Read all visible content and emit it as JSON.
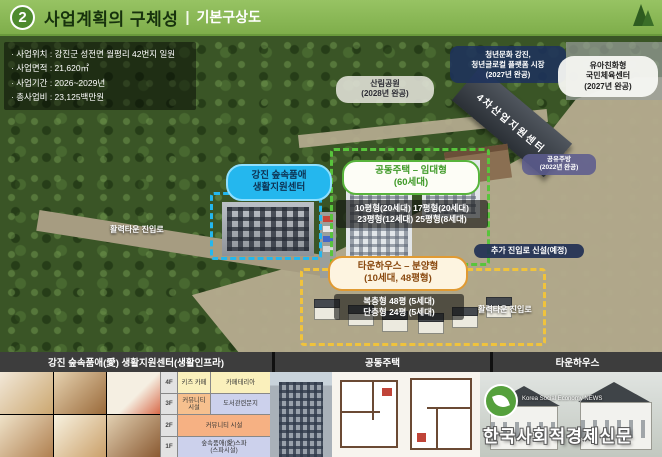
{
  "header": {
    "number": "2",
    "title": "사업계획의 구체성",
    "separator": "|",
    "subtitle": "기본구상도"
  },
  "info_box": {
    "lines": [
      "· 사업위치 : 강진군 성전면 월평리 42번지 일원",
      "· 사업면적 : 21,620㎡",
      "· 사업기간 : 2026~2029년",
      "· 총사업비 : 23,125백만원"
    ]
  },
  "map": {
    "forest_park_label": {
      "name": "산림공원",
      "year": "(2028년 완공)"
    },
    "youth_platform_label": {
      "line1": "청년문화 강진,",
      "line2": "청년글로컬 플랫폼 시장",
      "line3": "(2027년 완공)"
    },
    "sports_center_label": {
      "line1": "유아친화형",
      "line2": "국민체육센터",
      "line3": "(2027년 완공)"
    },
    "industry_center_label": "4차산업지원센터",
    "shared_kitchen_label": {
      "name": "공유주방",
      "year": "(2022년 완공)"
    },
    "support_center_label": {
      "line1": "강진 숲속품애",
      "line2": "생활지원센터"
    },
    "apartment_label": {
      "title": "공동주택 – 임대형",
      "units": "(60세대)",
      "detail_line1": "10평형(20세대)  17평형(20세대)",
      "detail_line2": "23평형(12세대)  25평형(8세대)"
    },
    "townhouse_label": {
      "title": "타운하우스 – 분양형",
      "units": "(10세대, 48평형)",
      "detail_line1": "복층형 48평 (5세대)",
      "detail_line2": "단층형 24평 (5세대)"
    },
    "new_access_label": "추가 진입로 신설(예정)",
    "access_road_left_label": "활력타운 진입로",
    "access_road_right_label": "활력타운 진입로"
  },
  "bottom": {
    "section_titles": [
      "강진 숲속품애(愛) 생활지원센터(생활인프라)",
      "공동주택",
      "타운하우스"
    ],
    "floor_table": {
      "rows": [
        {
          "floor": "4F",
          "left": "키즈 카페",
          "right": "카페테리아"
        },
        {
          "floor": "3F",
          "left": "커뮤니티 시설",
          "right": "도서관련문지"
        },
        {
          "floor": "2F",
          "full": "커뮤니티 시설"
        },
        {
          "floor": "1F",
          "full_line1": "숲속품애(愛)스파",
          "full_line2": "(스파시설)"
        }
      ]
    },
    "watermark": {
      "agency": "Korea Social Economy NEWS",
      "name": "한국사회적경제신문"
    }
  },
  "colors": {
    "header_green": "#8CBB57",
    "accent_cyan": "#24B7EE",
    "accent_green": "#58B43C",
    "accent_orange": "#E09A32",
    "dark_navy": "#1E325C"
  }
}
